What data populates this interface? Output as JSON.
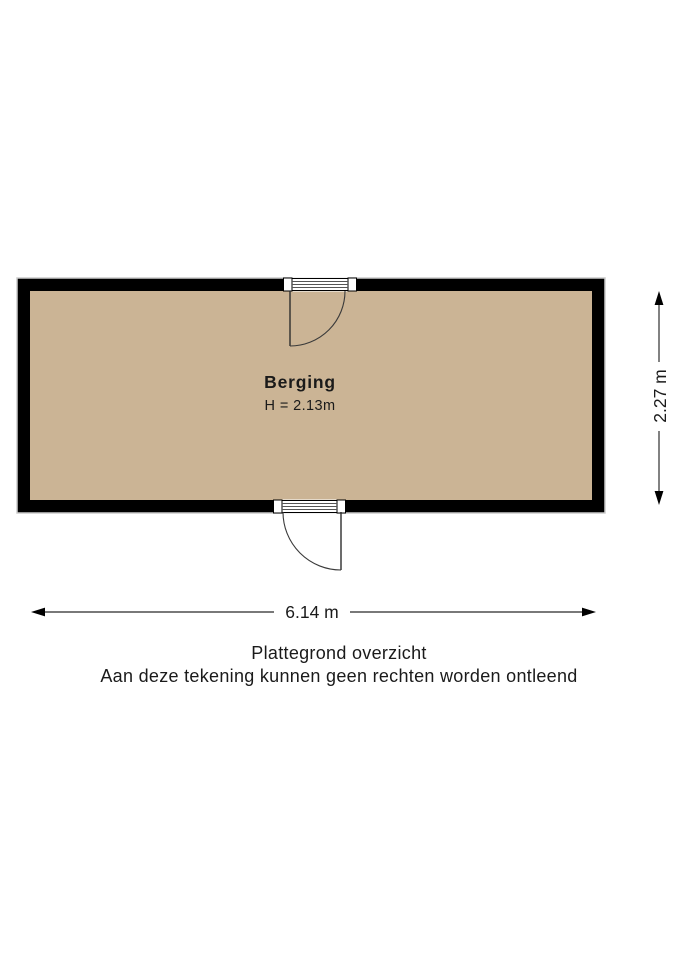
{
  "floorplan": {
    "room": {
      "name": "Berging",
      "ceiling_height": "H = 2.13m"
    },
    "dimensions": {
      "width": "6.14 m",
      "height": "2.27 m"
    },
    "caption": {
      "line1": "Plattegrond overzicht",
      "line2": "Aan deze tekening kunnen geen rechten worden ontleend"
    },
    "colors": {
      "floor": "#cbb495",
      "wall": "#000000",
      "wall_outline": "#cccccc",
      "door_line": "#3a3a3a",
      "dimension_line": "#4d4d4d",
      "text": "#1a1a1a"
    },
    "icons": {
      "dimension_arrows": "double-headed measurement arrows",
      "door_symbol": "quarter-circle door swing"
    }
  }
}
